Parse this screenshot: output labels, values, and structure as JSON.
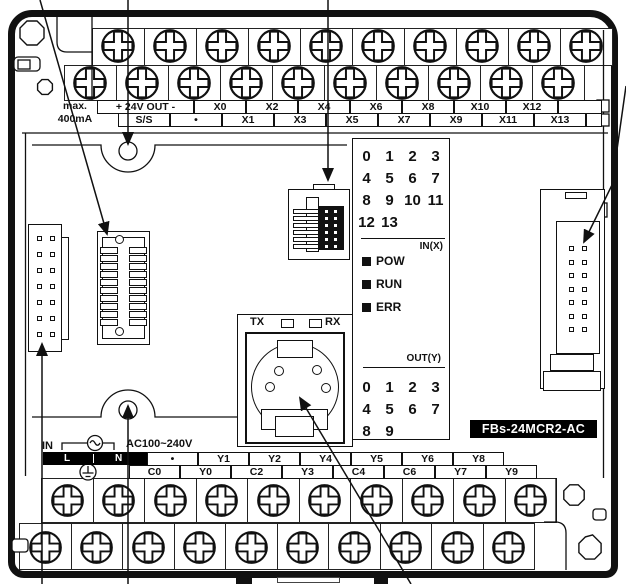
{
  "device": {
    "model": "FBs-24MCR2-AC"
  },
  "top_terminal_strip": {
    "note": [
      "max.",
      "400mA"
    ],
    "upper_labels": [
      "+ 24V OUT -",
      "X0",
      "X2",
      "X4",
      "X6",
      "X8",
      "X10",
      "X12"
    ],
    "lower_labels": [
      "S/S",
      "•",
      "X1",
      "X3",
      "X5",
      "X7",
      "X9",
      "X11",
      "X13"
    ]
  },
  "indicator_panel": {
    "input_numbers": [
      [
        "0",
        "1",
        "2",
        "3"
      ],
      [
        "4",
        "5",
        "6",
        "7"
      ],
      [
        "8",
        "9",
        "10",
        "11"
      ],
      [
        "12",
        "13"
      ]
    ],
    "input_group_label": "IN(X)",
    "status_leds": [
      "POW",
      "RUN",
      "ERR"
    ],
    "output_group_label": "OUT(Y)",
    "output_numbers": [
      [
        "0",
        "1",
        "2",
        "3"
      ],
      [
        "4",
        "5",
        "6",
        "7"
      ],
      [
        "8",
        "9"
      ]
    ]
  },
  "programming_port": {
    "tx_label": "TX",
    "rx_label": "RX"
  },
  "power_input": {
    "in_label": "IN",
    "voltage": "AC100~240V",
    "line": "L",
    "neutral": "N"
  },
  "bottom_terminal_strip": {
    "upper_labels": [
      "•",
      "Y1",
      "Y2",
      "Y4",
      "Y5",
      "Y6",
      "Y8"
    ],
    "lower_labels": [
      "C0",
      "Y0",
      "C2",
      "Y3",
      "C4",
      "C6",
      "Y7",
      "Y9"
    ]
  },
  "colors": {
    "line": "#111111",
    "model_label_bg": "#000000",
    "model_label_fg": "#ffffff"
  }
}
